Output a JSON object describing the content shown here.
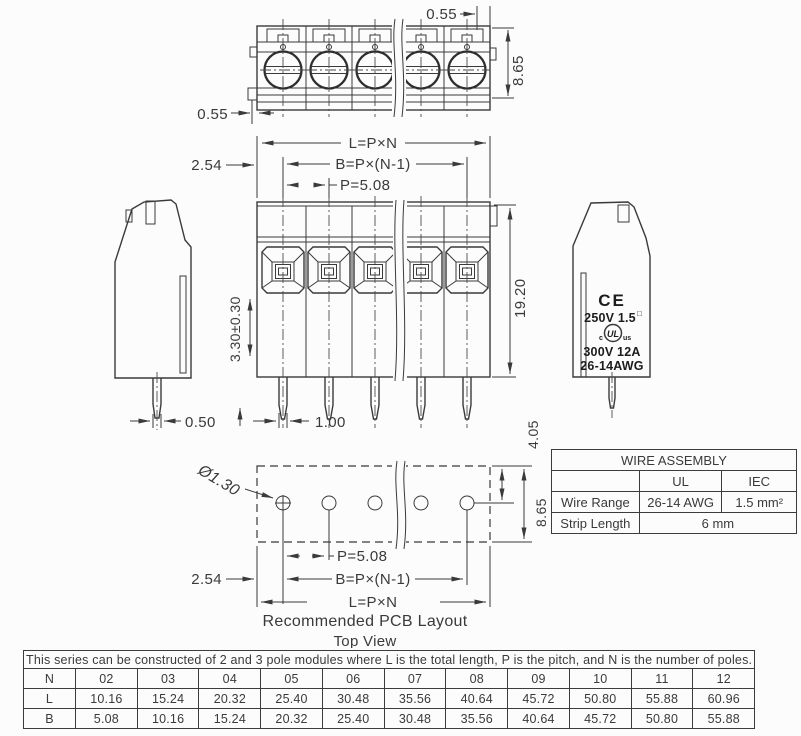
{
  "colors": {
    "background": "#fcfcfc",
    "line": "#3a3a3a",
    "text": "#3a3a3a"
  },
  "top_view": {
    "dim_wall_top": "0.55",
    "dim_depth": "8.65",
    "dim_wall_bottom": "0.55"
  },
  "front_view": {
    "dim_total_length": "L=P×N",
    "dim_mounting": "B=P×(N-1)",
    "dim_pitch": "P=5.08",
    "dim_edge_offset": "2.54",
    "dim_clamp_range": "3.30±0.30",
    "dim_height": "19.20",
    "dim_pin_width": "0.50",
    "dim_pin_thickness": "1.00"
  },
  "side_view": {
    "ce_mark": "CE",
    "rating_voltage": "250V 1.5",
    "rating_voltage_sup": "□",
    "ul_c": "c",
    "ul_mark": "UL",
    "ul_us": "us",
    "rating_current": "300V 12A",
    "rating_wire": "26-14AWG"
  },
  "pcb_layout": {
    "hole_diameter": "Ø1.30",
    "dim_pitch": "P=5.08",
    "dim_mounting": "B=P×(N-1)",
    "dim_total_length": "L=P×N",
    "dim_edge_offset": "2.54",
    "dim_hole_offset": "4.05",
    "dim_depth": "8.65",
    "caption": "Recommended PCB Layout",
    "subcaption": "Top View"
  },
  "wire_table": {
    "title": "WIRE ASSEMBLY",
    "col_ul": "UL",
    "col_iec": "IEC",
    "wire_range_label": "Wire Range",
    "wire_range_ul": "26-14 AWG",
    "wire_range_iec": "1.5 mm²",
    "strip_length_label": "Strip Length",
    "strip_length_value": "6 mm"
  },
  "dimension_table": {
    "caption": "This series can be constructed of 2 and 3 pole modules where L is the total length, P is the pitch, and N is the number of poles.",
    "label_n": "N",
    "label_l": "L",
    "label_b": "B",
    "n": [
      "02",
      "03",
      "04",
      "05",
      "06",
      "07",
      "08",
      "09",
      "10",
      "11",
      "12"
    ],
    "l": [
      "10.16",
      "15.24",
      "20.32",
      "25.40",
      "30.48",
      "35.56",
      "40.64",
      "45.72",
      "50.80",
      "55.88",
      "60.96"
    ],
    "b": [
      "5.08",
      "10.16",
      "15.24",
      "20.32",
      "25.40",
      "30.48",
      "35.56",
      "40.64",
      "45.72",
      "50.80",
      "55.88"
    ]
  }
}
